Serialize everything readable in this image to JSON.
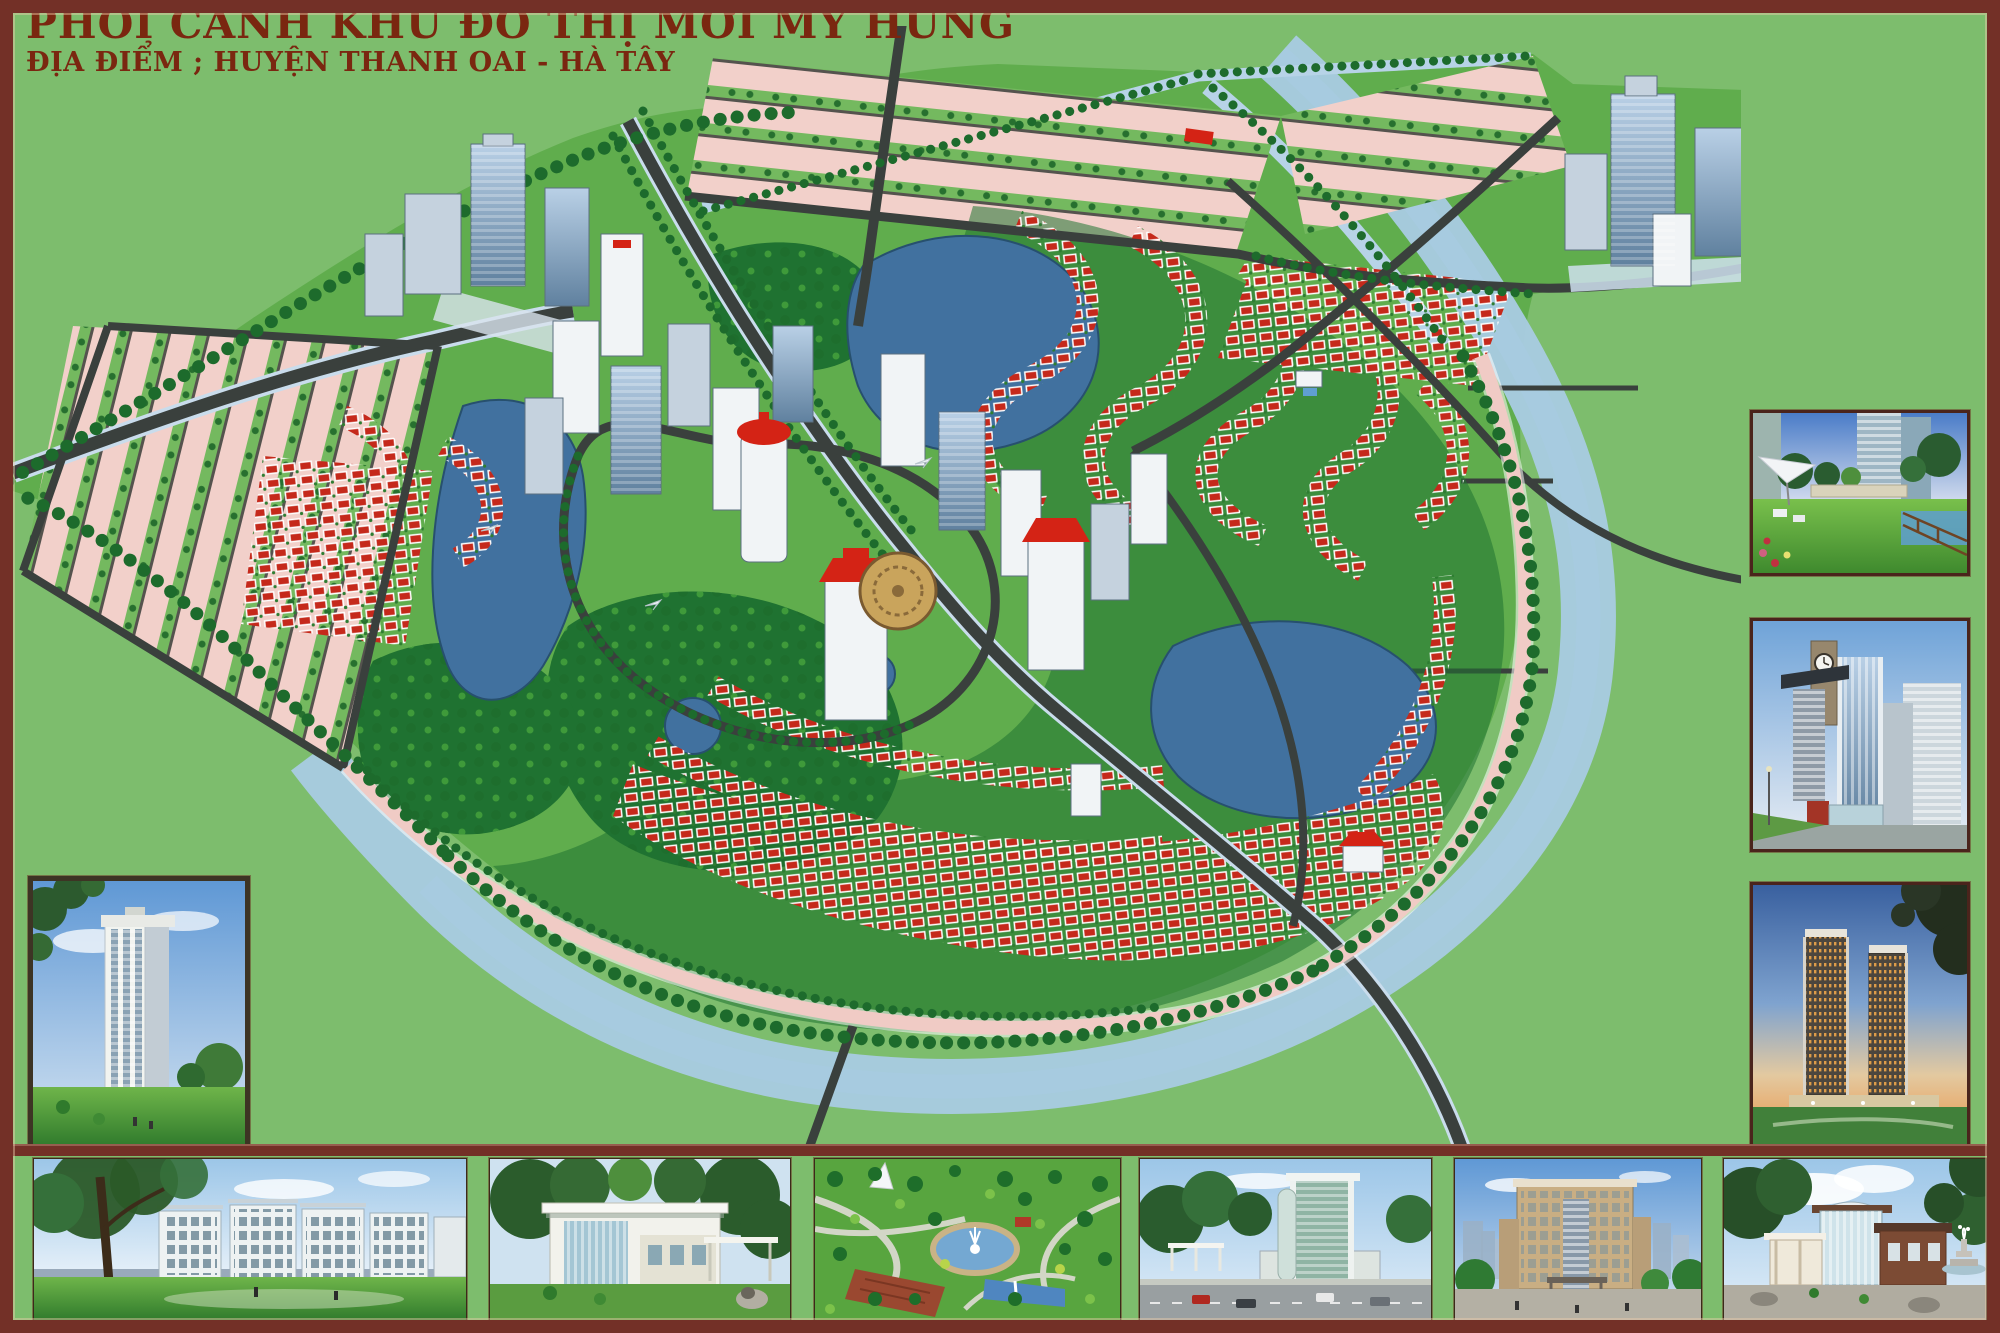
{
  "header": {
    "title": "PHỐI CẢNH KHU ĐÔ THỊ MỚI MỸ HƯNG",
    "subtitle": "ĐỊA ĐIỂM ; HUYỆN THANH OAI - HÀ TÂY"
  },
  "colors": {
    "frame": "#733027",
    "canvas": "#7dbd6d",
    "title-text": "#7a2710",
    "river": "#a9cbe3",
    "lake": "#41719f",
    "road": "#3a403d",
    "road-edge": "#c9dcec",
    "parcel": "#f2d0ca",
    "villa-red": "#c5291b",
    "park": "#1f7231",
    "tree": "#1d6b2c",
    "promenade": "#f0cbc5",
    "plaza": "#c9a45c",
    "landmark": "#d42315"
  }
}
